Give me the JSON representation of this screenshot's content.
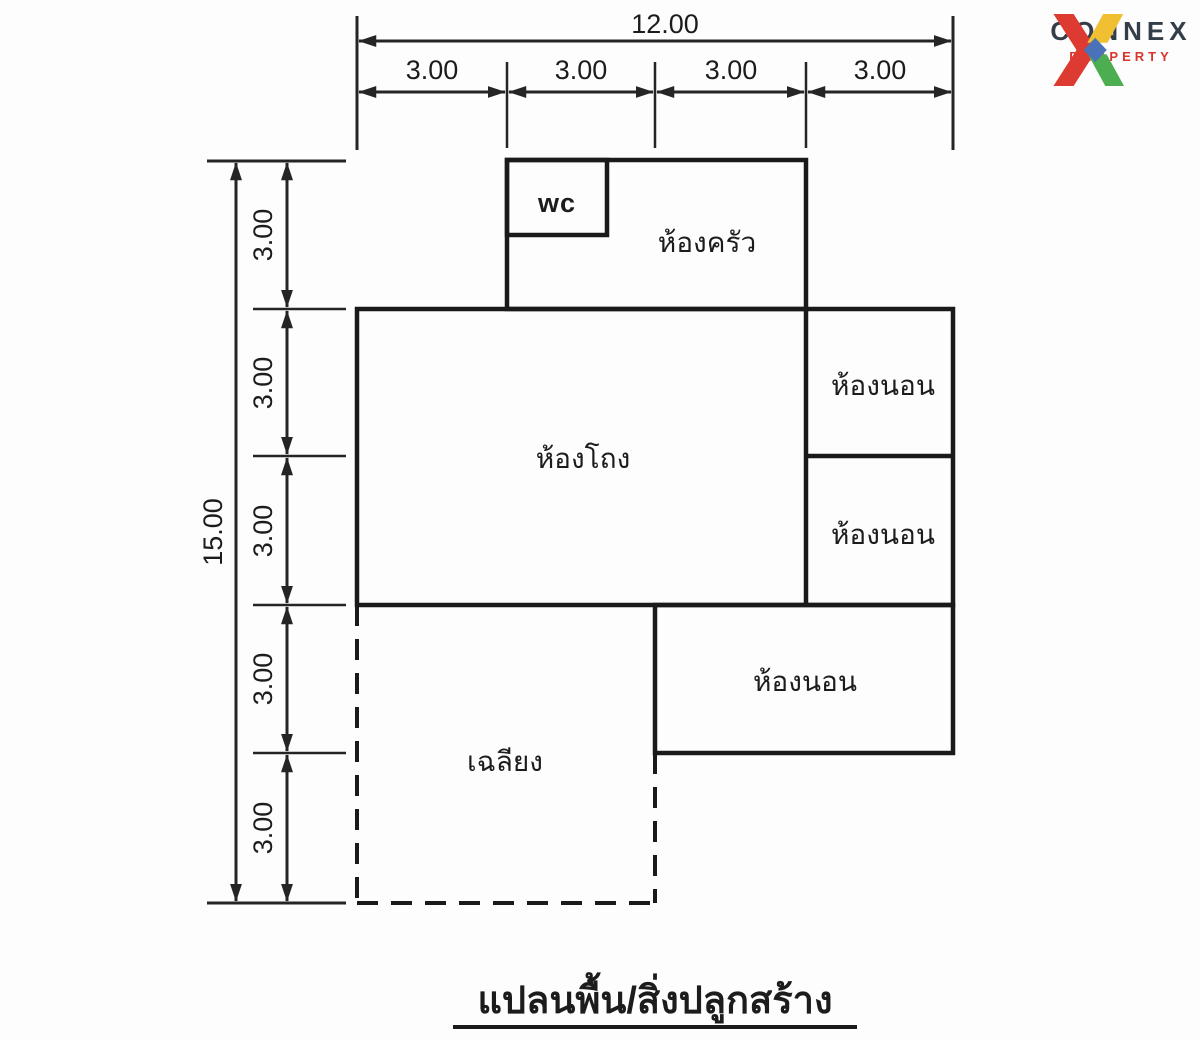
{
  "title": "แปลนพื้น/สิ่งปลูกสร้าง",
  "dims": {
    "top": {
      "total": "12.00",
      "segments": [
        "3.00",
        "3.00",
        "3.00",
        "3.00"
      ]
    },
    "left": {
      "total": "15.00",
      "segments": [
        "3.00",
        "3.00",
        "3.00",
        "3.00",
        "3.00"
      ]
    }
  },
  "rooms": {
    "wc": "wc",
    "kitchen": "ห้องครัว",
    "hall": "ห้องโถง",
    "bedroom_top": "ห้องนอน",
    "bedroom_mid": "ห้องนอน",
    "bedroom_bottom": "ห้องนอน",
    "porch": "เฉลียง"
  },
  "logo": {
    "name": "CONNEX",
    "subtitle": "PROPERTY",
    "colors": {
      "red": "#dd3a31",
      "yellow": "#f0c032",
      "green": "#4cae50",
      "blue": "#4a72b8",
      "name_color": "#333e48",
      "subtitle_color": "#d9352e"
    }
  },
  "colors": {
    "wall": "#1a1a1a",
    "dimension": "#252525",
    "background": "#fdfdfd"
  }
}
